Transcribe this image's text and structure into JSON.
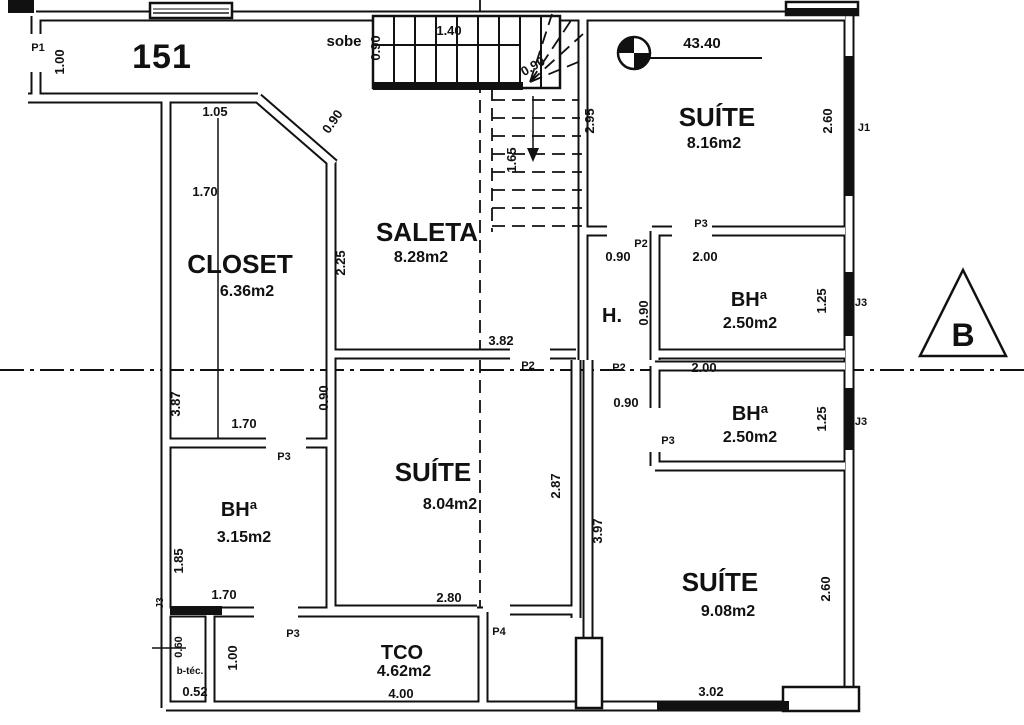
{
  "title": {
    "unit": "151"
  },
  "stair": {
    "note": "sobe"
  },
  "level": {
    "elevation": "43.40"
  },
  "section": {
    "label": "B"
  },
  "rooms": [
    {
      "name": "SUÍTE",
      "area": "8.16m2"
    },
    {
      "name": "BHª",
      "area": "2.50m2"
    },
    {
      "name": "BHª",
      "area": "2.50m2"
    },
    {
      "name": "SUÍTE",
      "area": "9.08m2"
    },
    {
      "name": "SUÍTE",
      "area": "8.04m2"
    },
    {
      "name": "SALETA",
      "area": "8.28m2"
    },
    {
      "name": "CLOSET",
      "area": "6.36m2"
    },
    {
      "name": "BHª",
      "area": "3.15m2"
    },
    {
      "name": "TCO",
      "area": "4.62m2"
    },
    {
      "name": "H."
    },
    {
      "name": "b-téc."
    }
  ],
  "doors": {
    "p1": "P1",
    "p2": "P2",
    "p3": "P3",
    "p4": "P4"
  },
  "windows": {
    "j1": "J1",
    "j3": "J3"
  },
  "dimensions": [
    "1.00",
    "0.90",
    "1.40",
    "0.90",
    "1.65",
    "2.95",
    "2.60",
    "2.00",
    "1.25",
    "0.90",
    "0.90",
    "2.25",
    "0.90",
    "1.05",
    "1.70",
    "3.82",
    "2.00",
    "1.25",
    "0.90",
    "3.87",
    "1.70",
    "0.90",
    "2.87",
    "3.97",
    "1.85",
    "1.70",
    "2.80",
    "4.00",
    "1.00",
    "0.60",
    "0.52",
    "2.60",
    "3.02"
  ]
}
